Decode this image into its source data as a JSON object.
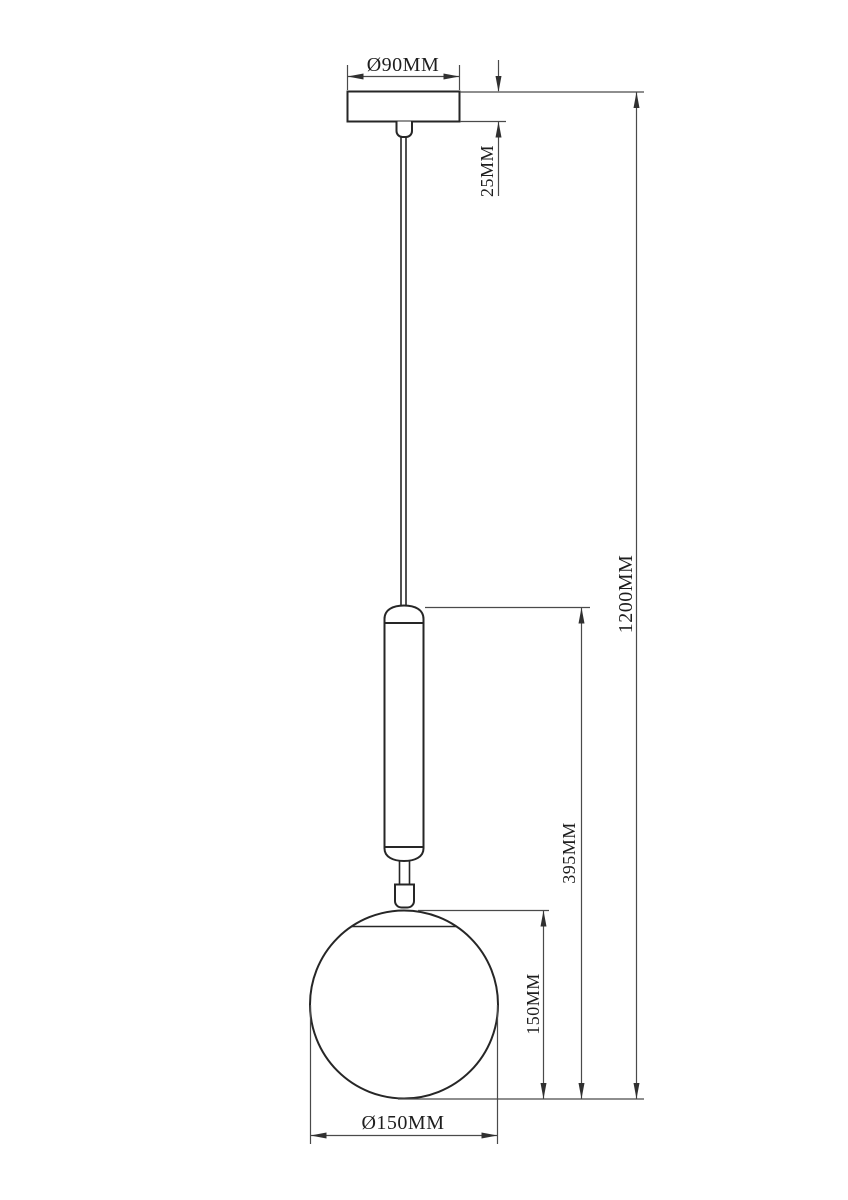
{
  "drawing": {
    "kind": "pendant-lamp-dimension-drawing",
    "labels": {
      "canopy_diameter": "Ø90MM",
      "canopy_height": "25MM",
      "overall_height": "1200MM",
      "lower_section_height": "395MM",
      "globe_height": "150MM",
      "globe_diameter": "Ø150MM"
    },
    "colors": {
      "background": "#ffffff",
      "object_line": "#262626",
      "dimension_line": "#4a4a4a",
      "text": "#1e1e1e"
    }
  }
}
